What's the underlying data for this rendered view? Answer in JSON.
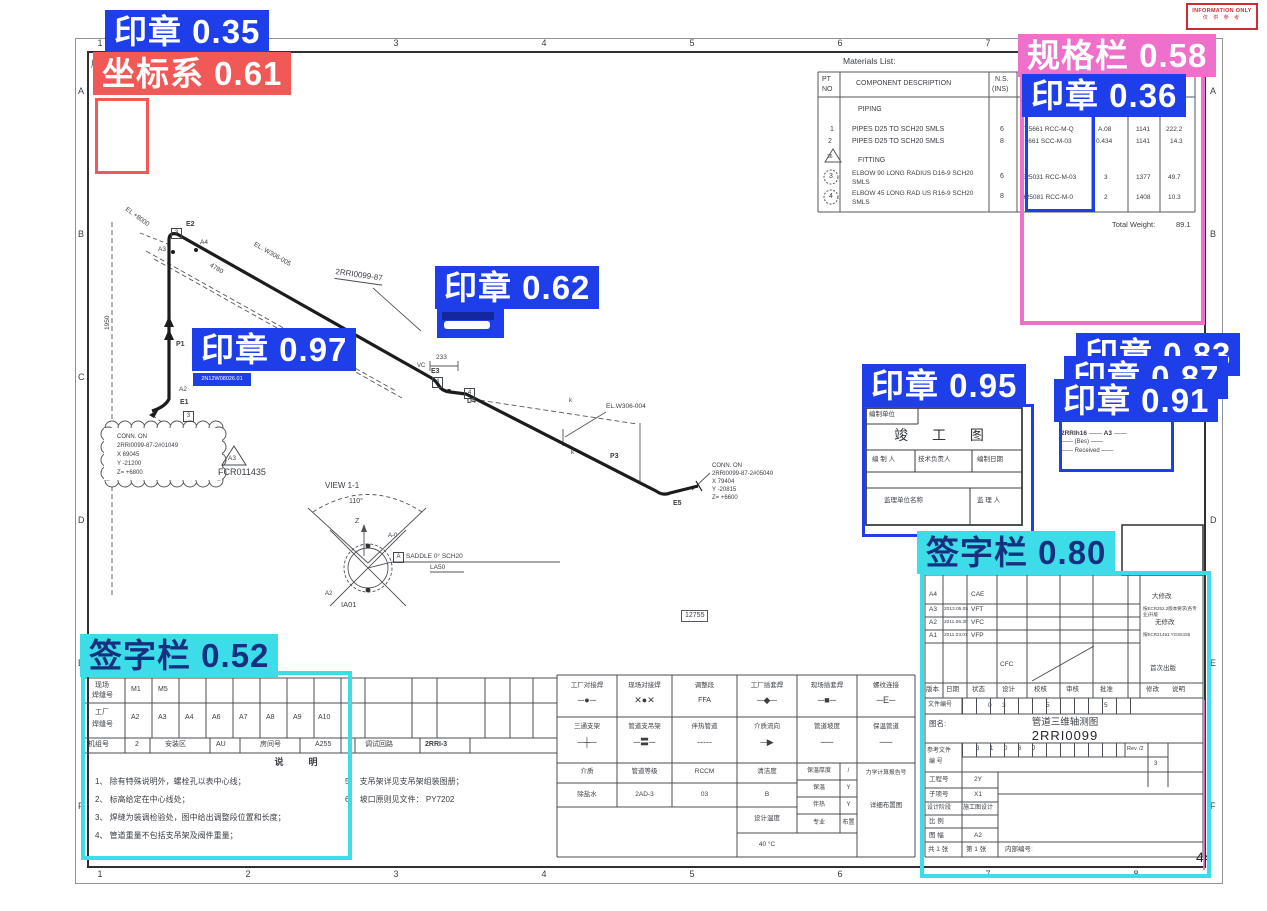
{
  "overlays": {
    "seal35": {
      "label": "印章",
      "score": "0.35"
    },
    "coord61": {
      "label": "坐标系",
      "score": "0.61"
    },
    "spec58": {
      "label": "规格栏",
      "score": "0.58"
    },
    "seal36": {
      "label": "印章",
      "score": "0.36"
    },
    "seal62": {
      "label": "印章",
      "score": "0.62"
    },
    "seal97": {
      "label": "印章",
      "score": "0.97"
    },
    "seal95": {
      "label": "印章",
      "score": "0.95"
    },
    "seal83": {
      "label": "印章",
      "score": "0.83"
    },
    "seal87": {
      "label": "印章",
      "score": "0.87"
    },
    "seal91": {
      "label": "印章",
      "score": "0.91"
    },
    "sign80": {
      "label": "签字栏",
      "score": "0.80"
    },
    "sign52": {
      "label": "签字栏",
      "score": "0.52"
    }
  },
  "colors": {
    "seal": "#1e3eea",
    "coord": "#f15956",
    "spec": "#ef70cb",
    "sign": "#3ddce9"
  },
  "info_stamp": {
    "line1": "INFORMATION ONLY",
    "line2": "仅 供 参 考"
  },
  "border": {
    "top": [
      "1",
      "2",
      "3",
      "4",
      "5",
      "6",
      "7",
      "8"
    ],
    "bottom": [
      "1",
      "2",
      "3",
      "4",
      "5",
      "6",
      "7",
      "8"
    ],
    "left": [
      "A",
      "B",
      "C",
      "D",
      "E",
      "F"
    ],
    "right": [
      "A",
      "B",
      "C",
      "D",
      "E",
      "F"
    ],
    "corner_mark": "版",
    "page_no": "44"
  },
  "materials": {
    "title": "Materials List:",
    "h_pt": "PT",
    "h_no": "NO",
    "h_desc": "COMPONENT DESCRIPTION",
    "h_ns": "N.S.",
    "h_ns2": "(INS)",
    "sec1": "PIPING",
    "sec2": "FITTING",
    "tri": "36",
    "r1": {
      "no": "1",
      "desc": "PIPES D25 TO SCH20 SMLS",
      "ns": "6",
      "code": "T25661 RCC-M-Q",
      "qty": "A.08",
      "unit": "1141",
      "wt": "222.2"
    },
    "r2": {
      "no": "2",
      "desc": "PIPES D25 TO SCH20 SMLS",
      "ns": "8",
      "code": "25661 SCC-M-03",
      "qty": "0.434",
      "unit": "1141",
      "wt": "14.3"
    },
    "r3": {
      "no": "3",
      "desc": "ELBOW 90 LONG RADIUS D16-9 SCH20",
      "desc2": "SMLS",
      "ns": "6",
      "code": "E25031 RCC-M-03",
      "qty": "3",
      "unit": "1377",
      "wt": "49.7"
    },
    "r4": {
      "no": "4",
      "desc": "ELBOW 45 LONG RAD US R16-9 SCH20",
      "desc2": "SMLS",
      "ns": "8",
      "code": "H25081 RCC-M-0",
      "qty": "2",
      "unit": "1408",
      "wt": "10.3"
    },
    "total_label": "Total Weight:",
    "total_value": "89.1"
  },
  "drawing": {
    "e2": "E2",
    "e1": "E1",
    "e3": "E3",
    "e5": "E5",
    "d4": "D4",
    "p1": "P1",
    "p2": "P2",
    "p3": "P3",
    "a2": "A2",
    "a3": "A3",
    "a4": "A4",
    "vc": "VC",
    "b3": "3",
    "b4": "4",
    "k": "k",
    "dim233": "233",
    "dim4780": "4780",
    "dim1950": "1950",
    "el8000": "EL +8000",
    "elw305": "EL. W306-005",
    "elw304": "EL.W306-004",
    "line_no": "2RRI0099-87",
    "conn2": {
      "l1": "CONN. ON",
      "l2": "2RRI0099-87-2#05040",
      "l3": "X 79404",
      "l4": "Y -20815",
      "l5": "Z= +6600"
    },
    "cloud": {
      "l1": "CONN. ON",
      "l2": "2RRI0099-87-2#01049",
      "l3": "X 69045",
      "l4": "Y -21200",
      "l5": "Z= +6800"
    },
    "tri_label": "A3",
    "fcr": "FCR011435",
    "weld_stamp": "2N12W08026.01",
    "small_ref": "12755",
    "view": {
      "title": "VIEW 1-1",
      "angle": "110°",
      "z": "Z",
      "a0": "A-0",
      "a2": "A2",
      "ia01": "IA01",
      "callout_a": "A",
      "callout": "SADDLE 0° SCH20",
      "callout2": "LA50"
    }
  },
  "asbuilt": {
    "unit": "编制单位",
    "title": "竣 工 图",
    "c1": "编 制 人",
    "c2": "技术负责人",
    "c3": "编制日期",
    "c4": "监理单位名称",
    "c5": "监 理 人"
  },
  "test_stamp": {
    "l1": "NO FIELD DESIGN CHANGE",
    "l2": "VALID FOR TEST",
    "code": "2RRIh16",
    "rev": "A3",
    "dash": "——",
    "bes": "(Bes)",
    "received": "Received"
  },
  "legend": {
    "r1": [
      {
        "t": "工厂对接焊",
        "s": "─●─"
      },
      {
        "t": "现场对接焊",
        "s": "✕●✕"
      },
      {
        "t": "调整段",
        "s": "FFA"
      },
      {
        "t": "工厂插套焊",
        "s": "─◆─"
      },
      {
        "t": "现场插套焊",
        "s": "─■─"
      },
      {
        "t": "螺纹连接",
        "s": "─E─"
      }
    ],
    "r2": [
      {
        "t": "三通支架",
        "s": "─┼─"
      },
      {
        "t": "管道支吊架",
        "s": "─〓─"
      },
      {
        "t": "伴热管道",
        "s": "-----"
      },
      {
        "t": "介质流向",
        "s": "─▶"
      },
      {
        "t": "管道坡度",
        "s": "──"
      },
      {
        "t": "保温管道",
        "s": "──"
      }
    ],
    "l_medium": "介质",
    "v_medium": "除盐水",
    "l_class": "管道等级",
    "v_class": "2AD-3",
    "l_rccm": "RCCM",
    "v_rccm": "03",
    "l_clean": "清洁度",
    "v_clean": "B",
    "l_temp": "设计温度",
    "v_temp": "40 °C",
    "l_ins_th": "保温厚度",
    "v_ins_th": "/",
    "l_ins": "保温",
    "v_ins": "Y",
    "l_heat": "伴热",
    "v_heat": "Y",
    "l_spec": "专业",
    "v_spec": "布置",
    "l_mech": "力学计算报告号",
    "v_detail": "详细布置图"
  },
  "weld_table": {
    "row1_label1": "现场",
    "row1_label2": "焊缝号",
    "row1": [
      "M1",
      "M5",
      "",
      "",
      "",
      "",
      "",
      ""
    ],
    "row2_label1": "工厂",
    "row2_label2": "焊缝号",
    "row2": [
      "A2",
      "A3",
      "A4",
      "A6",
      "A7",
      "A8",
      "A9",
      "A10"
    ],
    "unit_label": "机组号",
    "unit_val": "2",
    "area_label": "安装区",
    "area_val": "AU",
    "room_label": "房间号",
    "room_val": "A255",
    "loop_label": "调试回路",
    "loop_val": "2RRI-3"
  },
  "notes": {
    "title": "说　明",
    "n1": "1、 除有特殊说明外，螺栓孔以表中心线；",
    "n2": "2、 标高给定在中心线处；",
    "n3": "3、 焊缝为装调检验处，图中给出调整段位置和长度；",
    "n4": "4、 管道重量不包括支吊架及阀件重量；",
    "n5": "5、 支吊架详见支吊架组装图册；",
    "n6": "6、 坡口原则见文件： PY7202"
  },
  "title_block": {
    "revisions": [
      {
        "ver": "A4",
        "date": "",
        "status": "CAE",
        "remark": "大修改"
      },
      {
        "ver": "A3",
        "date": "2013.05.05",
        "status": "VFT",
        "remark": "按ECR252.2版本要求(各专业)升版"
      },
      {
        "ver": "A2",
        "date": "2011.06.30",
        "status": "VFC",
        "remark": "无修改"
      },
      {
        "ver": "A1",
        "date": "2011.03.07",
        "status": "VFP",
        "remark": "按ECR21451 YGS5155"
      },
      {
        "ver": "",
        "date": "",
        "status": "CFC",
        "remark": "首次出版"
      }
    ],
    "headers": [
      "版本",
      "日期",
      "状态",
      "设计",
      "校核",
      "审核",
      "批准",
      "修改",
      "说明"
    ],
    "doc_label": "文件编号",
    "doc_digits": {
      "d1": "0",
      "d2": "3",
      "d3": "5",
      "d4": "5"
    },
    "name_label": "图名:",
    "name1": "管道三维轴测图",
    "name2": "2RRI0099",
    "ref_label1": "参考文件",
    "ref_label2": "编 号",
    "ref_digits": {
      "d1": "3",
      "d2": "1",
      "d3": "0",
      "d4": "6",
      "d5": "J"
    },
    "rev_cell": "Rev",
    "rev_val": "/2",
    "side_mid": "3",
    "f1_l": "工程号",
    "f1_v": "2Y",
    "f2_l": "子项号",
    "f2_v": "X1",
    "f3_l": "设计阶段",
    "f3_v": "施工图设计",
    "f4_l": "比  例",
    "f4_v": "",
    "f5_l": "图  幅",
    "f5_v": "A2",
    "sheets1": "共 1 张",
    "sheets2": "第 1 张",
    "internal": "内部编号:"
  }
}
